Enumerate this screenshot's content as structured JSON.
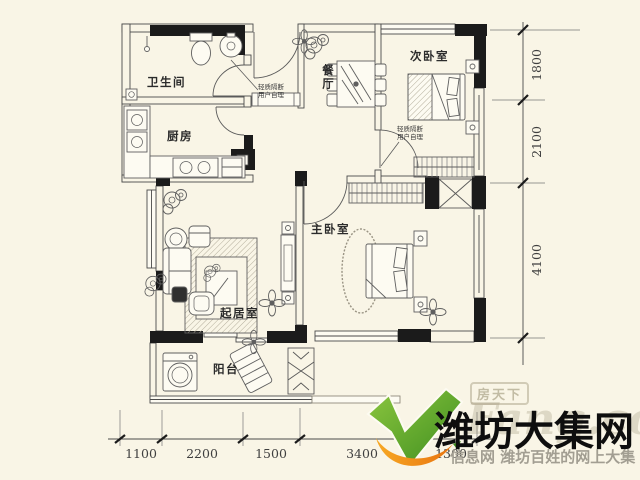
{
  "plan": {
    "rooms": [
      {
        "id": "bathroom",
        "label": "卫生间"
      },
      {
        "id": "kitchen",
        "label": "厨房"
      },
      {
        "id": "dining",
        "label": "餐厅"
      },
      {
        "id": "second-bedroom",
        "label": "次卧室"
      },
      {
        "id": "master-bedroom",
        "label": "主卧室"
      },
      {
        "id": "living-room",
        "label": "起居室"
      },
      {
        "id": "balcony",
        "label": "阳台"
      }
    ],
    "partition_note": {
      "line1": "轻质隔断",
      "line2": "用户自理"
    }
  },
  "dimensions": {
    "bottom": [
      "1100",
      "2200",
      "1500",
      "3400",
      "1300"
    ],
    "right": [
      "1800",
      "2100",
      "4100"
    ]
  },
  "watermark": {
    "title": "潍坊大集网",
    "subtitle": "信息网 潍坊百姓的网上大集",
    "ghost_box": "房天下",
    "ghost_script": "Fang.com",
    "green": "#4aa321",
    "orange": "#f08c1e"
  },
  "colors": {
    "background": "#f9f5e6",
    "wall": "#1b1b1b",
    "line": "#4a4a4a"
  }
}
